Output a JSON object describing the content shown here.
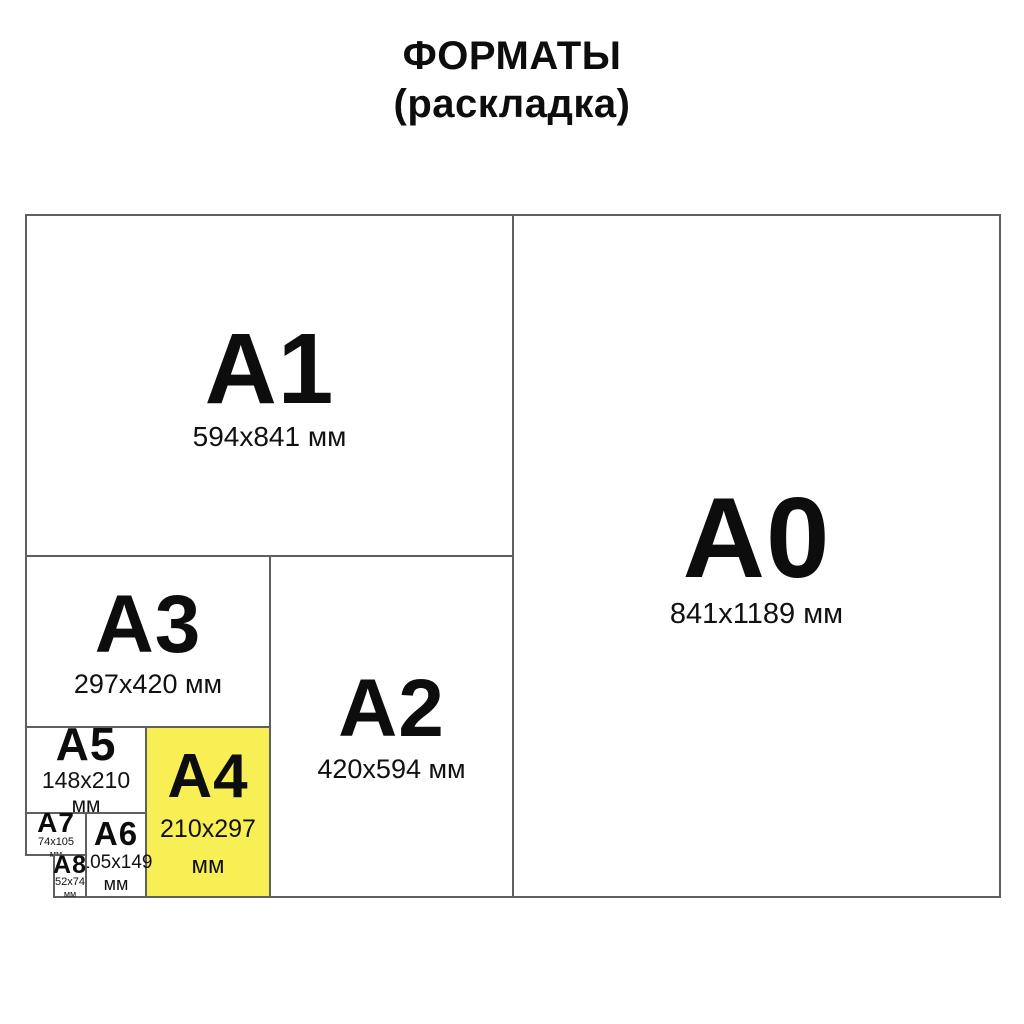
{
  "title": {
    "line1": "ФОРМАТЫ",
    "line2": "(раскладка)"
  },
  "colors": {
    "highlight_yellow": "#F8EF54",
    "border_gray": "#5f5f5f",
    "text_black": "#111111"
  },
  "formats": {
    "a0": {
      "label": "A0",
      "dims": "841x1189 мм"
    },
    "a1": {
      "label": "A1",
      "dims": "594x841 мм"
    },
    "a2": {
      "label": "A2",
      "dims": "420x594 мм"
    },
    "a3": {
      "label": "A3",
      "dims": "297x420 мм"
    },
    "a4": {
      "label": "A4",
      "dims": "210x297",
      "unit": "мм",
      "highlighted": true
    },
    "a5": {
      "label": "A5",
      "dims": "148x210",
      "unit": "мм"
    },
    "a6": {
      "label": "A6",
      "dims": "105x149",
      "unit": "мм"
    },
    "a7": {
      "label": "A7",
      "dims": "74x105",
      "unit": "мм"
    },
    "a8": {
      "label": "A8",
      "dims": "52x74",
      "unit": "мм"
    }
  }
}
